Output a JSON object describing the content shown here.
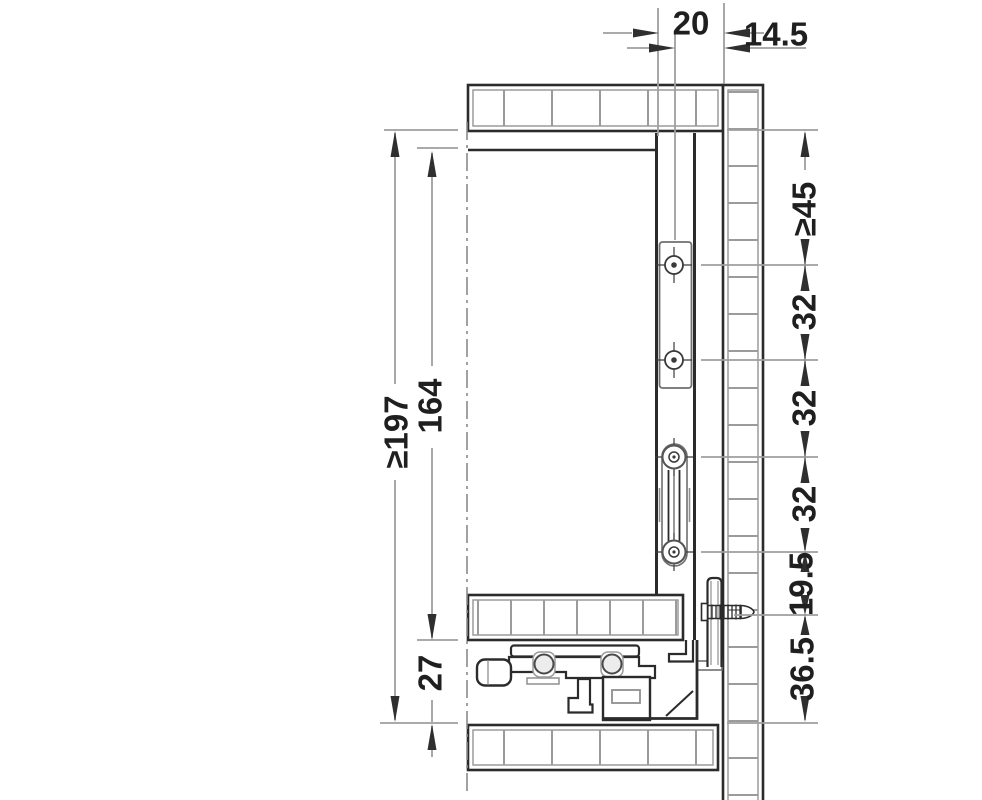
{
  "drawing": {
    "name": "drawer-system-installation-cross-section",
    "dims": {
      "top": [
        "20",
        "14.5"
      ],
      "left": [
        "≥197",
        "164",
        "27"
      ],
      "right": [
        "≥45",
        "32",
        "32",
        "32",
        "19.5",
        "36.5"
      ]
    },
    "colors": {
      "outline": "#2b2b2b",
      "secondary": "#8f8f8f",
      "hatch": "#9b9b9b",
      "dimension_line": "#9e9e9e",
      "arrow": "#2f2f2f",
      "text": "#1f1f1f",
      "background": "#ffffff"
    }
  }
}
